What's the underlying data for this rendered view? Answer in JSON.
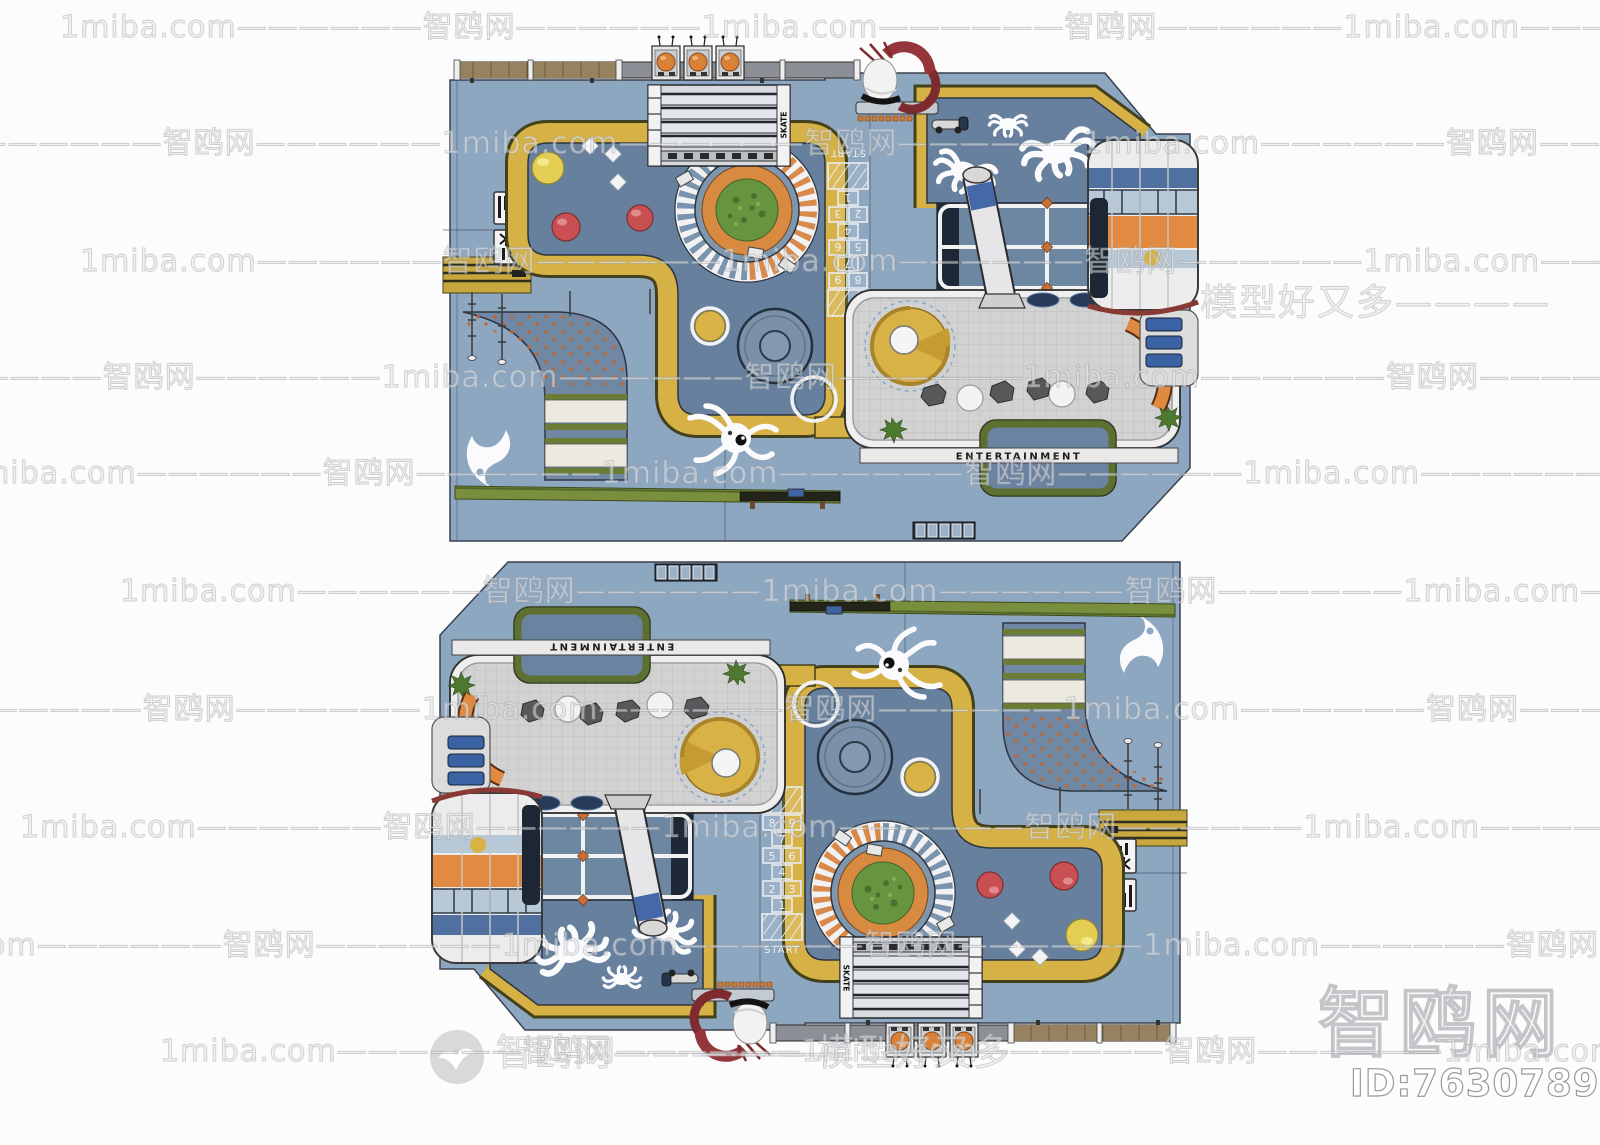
{
  "page": {
    "bg": "#fcfcfc",
    "width": 1600,
    "height": 1145
  },
  "watermark": {
    "site": "1miba.com",
    "brand": "智鸥网",
    "tile_text": "1miba.com——————智鸥网——————",
    "repeat": 3,
    "row_ys": [
      2,
      118,
      236,
      352,
      448,
      566,
      684,
      802,
      920,
      1026
    ],
    "row_offsets": [
      60,
      -200,
      80,
      -260,
      -40,
      120,
      -220,
      20,
      -140,
      160
    ],
    "mark_right": "模型好又多————",
    "mark_bottom": "———模型好又多",
    "mark_left": "智鸥网——————",
    "corner_brand": "智鸥网",
    "id_label": "ID:763078934",
    "logo": "seagull-logo"
  },
  "plan": {
    "deck_label": "ENTERTAINMENT",
    "track_label": "SKATE",
    "hopscotch": {
      "start": "START",
      "n1": "1",
      "n2": "2",
      "n3": "3",
      "n4": "4",
      "n5": "5",
      "n6": "6",
      "n7": "7",
      "n8": "8",
      "n9": "9"
    },
    "colors": {
      "base": "#8ea7c1",
      "zone": "#66809d",
      "path_yellow": "#d6b145",
      "orange": "#e08a41",
      "deck_gray": "#d2d2d2",
      "hedge_green": "#7a8f3e",
      "tower_blue": "#50709f",
      "sculpture_red": "#94363a",
      "carousel_green": "#67943f",
      "ball_red": "#c94f52",
      "ball_yellow": "#e3cd52"
    }
  }
}
